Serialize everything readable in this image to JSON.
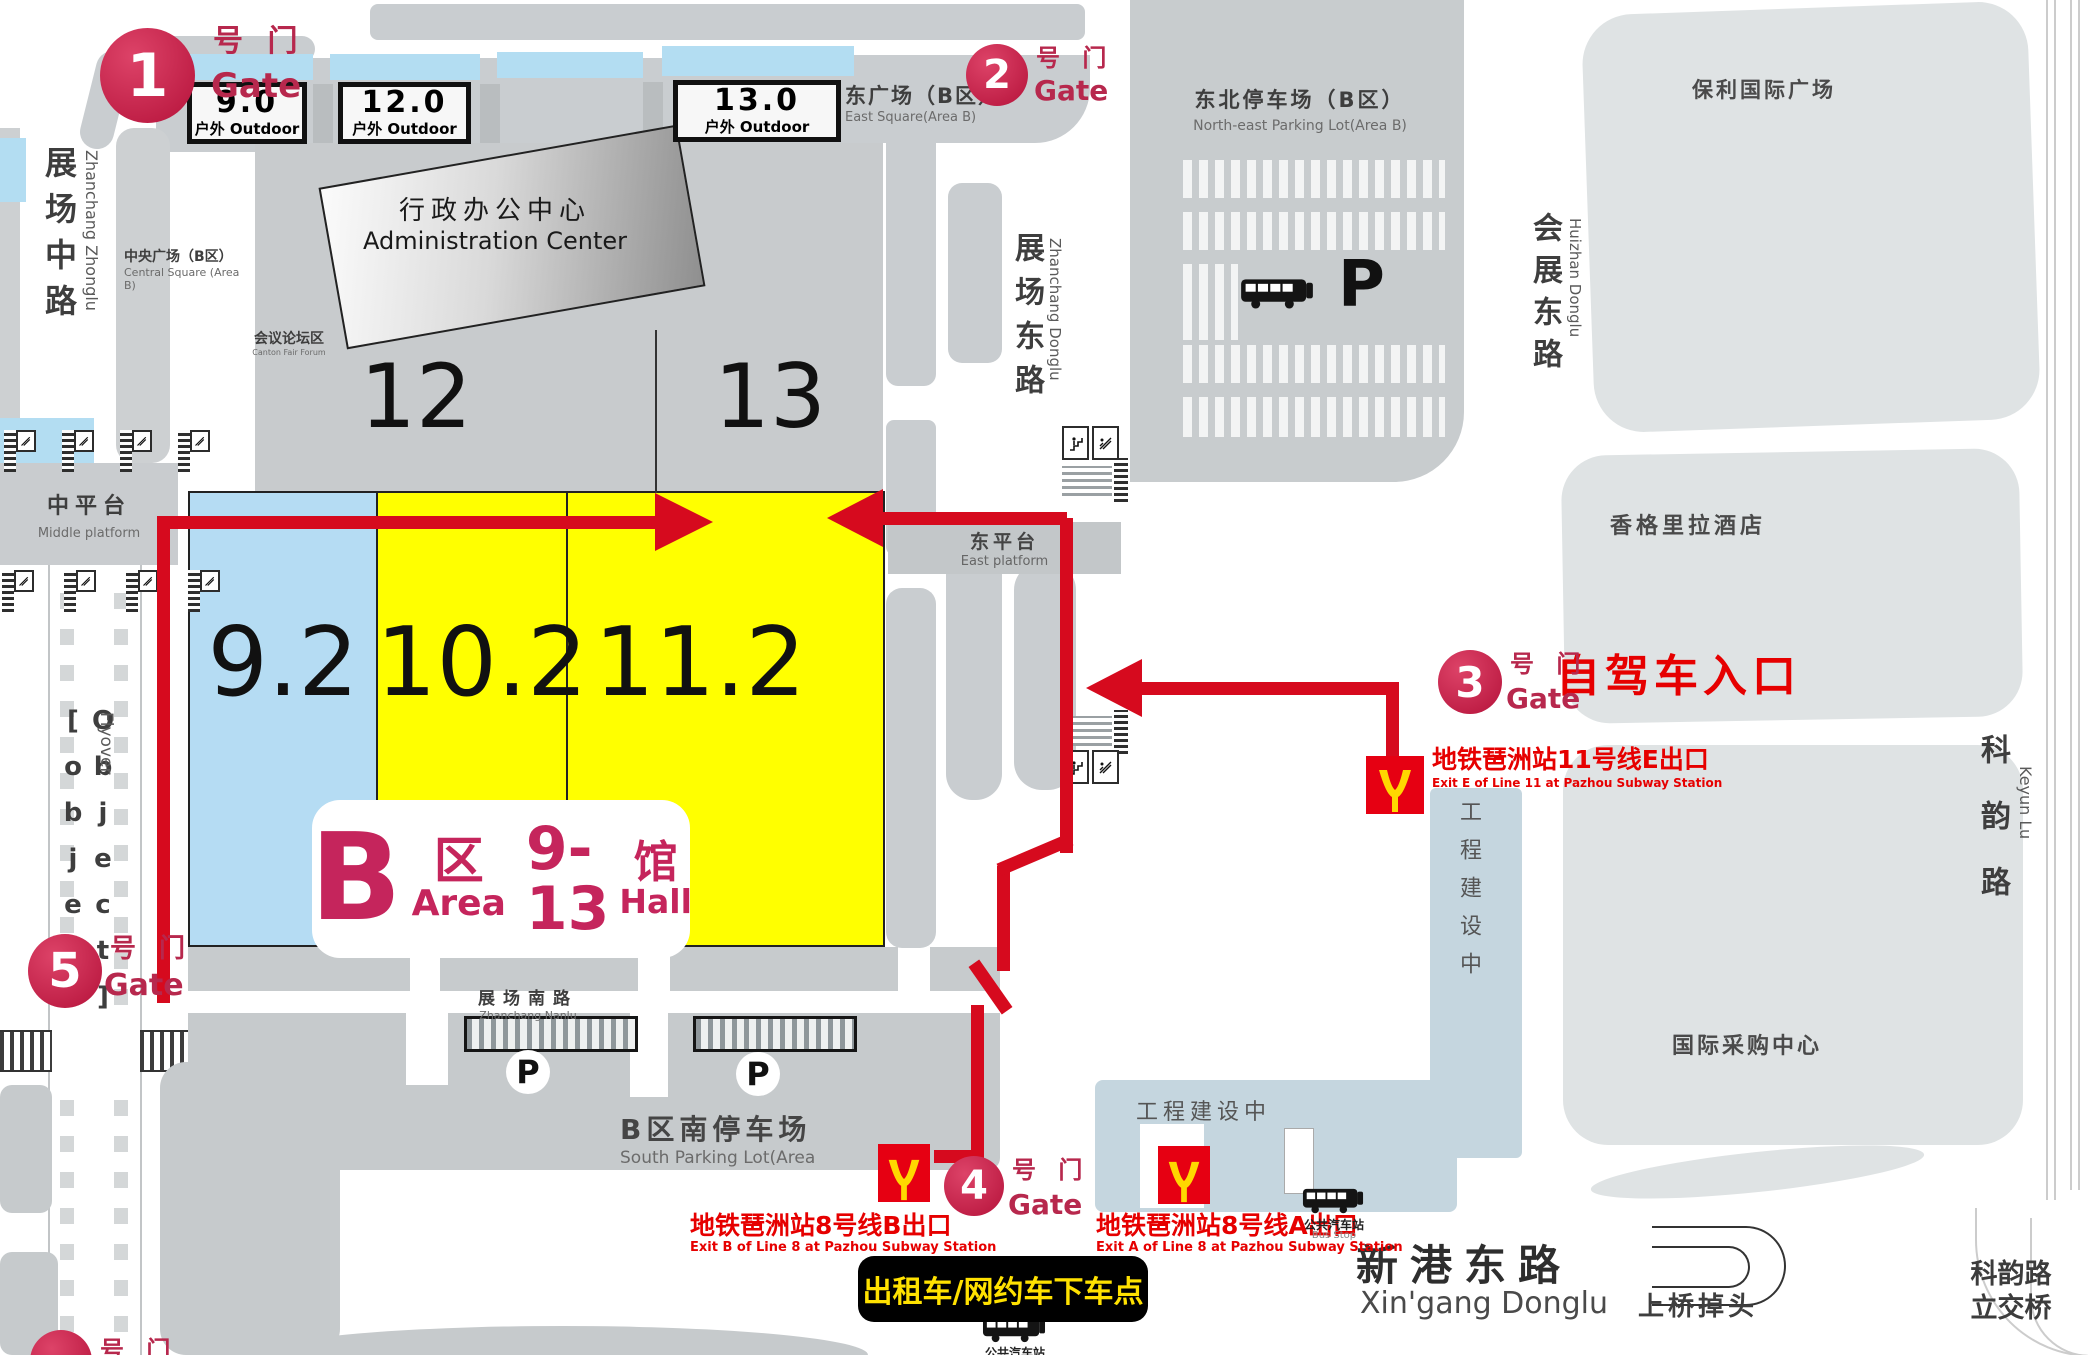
{
  "gates": [
    {
      "num": "1",
      "suffix": "号 门",
      "word": "Gate"
    },
    {
      "num": "2",
      "suffix": "号 门",
      "word": "Gate"
    },
    {
      "num": "3",
      "suffix": "号 门",
      "word": "Gate"
    },
    {
      "num": "4",
      "suffix": "号 门",
      "word": "Gate"
    },
    {
      "num": "5",
      "suffix": "号 门",
      "word": "Gate"
    },
    {
      "num": "",
      "suffix": "号 门",
      "word": ""
    }
  ],
  "outdoor": [
    {
      "num": "9.0",
      "sub": "户外 Outdoor"
    },
    {
      "num": "12.0",
      "sub": "户外 Outdoor"
    },
    {
      "num": "13.0",
      "sub": "户外 Outdoor"
    }
  ],
  "admin": {
    "cn": "行政办公中心",
    "en": "Administration Center",
    "n12": "12",
    "n13": "13"
  },
  "forum": {
    "cn": "会议论坛区",
    "en": "Canton Fair Forum"
  },
  "central_square": {
    "cn": "中央广场（B区）",
    "en": "Central Square (Area  B)"
  },
  "east_square": {
    "cn": "东广场（B区）",
    "en": "East Square(Area B)"
  },
  "east_platform": {
    "cn": "东平台",
    "en": "East platform"
  },
  "middle_platform": {
    "cn": "中平台",
    "en": "Middle platform"
  },
  "flyover": {
    "cn": "过街天桥",
    "en": "Flyover"
  },
  "halls": [
    {
      "num": "9.2"
    },
    {
      "num": "10.2"
    },
    {
      "num": "11.2"
    }
  ],
  "badge": {
    "b": "B",
    "qu": "区",
    "area": "Area",
    "range": "9-13",
    "guan": "馆",
    "hall": "Hall"
  },
  "roads": {
    "zz": {
      "cn": "展场中路",
      "en": "Zhanchang Zhonglu"
    },
    "zd": {
      "cn": "展场东路",
      "en": "Zhanchang Donglu"
    },
    "zn": {
      "cn": "展场南路",
      "en": "Zhanchang Nanlu"
    },
    "hz": {
      "cn": "会展东路",
      "en": "Huizhan Donglu"
    },
    "ky": {
      "cn": "科韵路",
      "en": "Keyun Lu"
    },
    "xg": {
      "cn": "新港东路",
      "en": "Xin'gang Donglu"
    }
  },
  "ne_parking": {
    "cn": "东北停车场（B区）",
    "en": "North-east Parking Lot(Area B)",
    "p": "P"
  },
  "south_parking": {
    "cn": "B区南停车场",
    "en": "South Parking Lot(Area",
    "p": "P"
  },
  "poly": "保利国际广场",
  "shangrila": "香格里拉酒店",
  "sourcing": "国际采购中心",
  "construction": "工程建设中",
  "keyun_bridge": "科韵路立交桥",
  "uturn": "上桥掉头",
  "metro": [
    {
      "cn": "地铁琶洲站8号线B出口",
      "en": "Exit B of Line 8 at Pazhou Subway Station"
    },
    {
      "cn": "地铁琶洲站8号线A出口",
      "en": "Exit A of Line 8 at Pazhou Subway Station"
    },
    {
      "cn": "地铁琶洲站11号线E出口",
      "en": "Exit E of Line 11 at Pazhou Subway Station"
    }
  ],
  "self_drive": "自驾车入口",
  "taxi": "出租车/网约车下车点",
  "bus_stop": {
    "cn": "公共汽车站",
    "en": "Bus Stop"
  },
  "colors": {
    "route_red": "#d60a1e",
    "gate_crimson": "#b7284d",
    "hall_yellow": "#ffff00",
    "hall_blue": "#b5dcf3",
    "metro_red": "#e60012",
    "metro_yellow": "#ffd800",
    "label_red": "#e60000",
    "taxi_bg": "#000000",
    "taxi_text": "#ffe100",
    "block_gray": "#c9cdd0"
  }
}
